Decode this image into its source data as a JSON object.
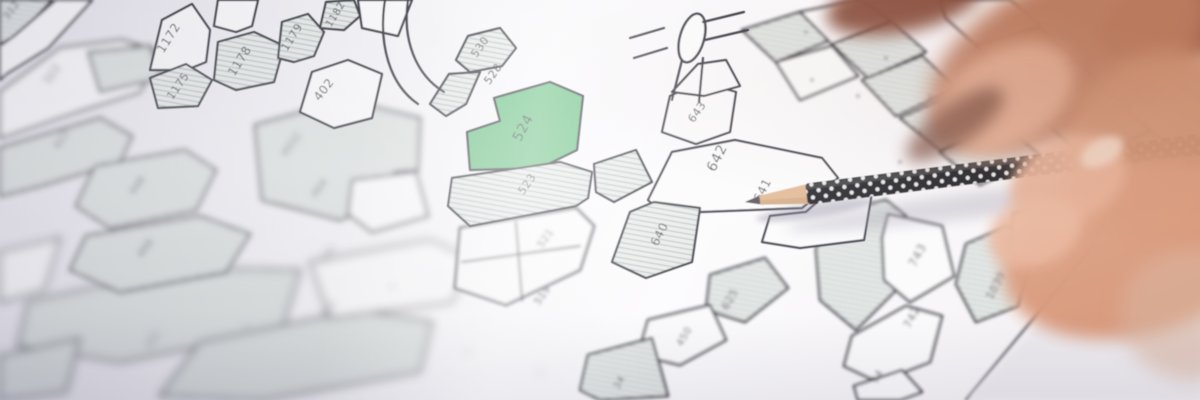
{
  "map": {
    "colors": {
      "line": "#34343e",
      "parcel_white": "#fbfbfc",
      "hatch_base": "#e8ebe9",
      "hatch_line": "#a3aeac",
      "highlight": "#68c081",
      "label": "#3b3b45",
      "highlight_label": "#2f4a38"
    },
    "highlighted_parcel": "524",
    "parcels": [
      {
        "pts": "150,70 162,20 192,4 210,30 206,62 186,70",
        "fill": "white",
        "g": "sharp"
      },
      {
        "pts": "214,26 218,0 258,0 252,26 236,32",
        "fill": "white",
        "g": "sharp"
      },
      {
        "pts": "150,78 186,64 212,80 198,106 158,108",
        "fill": "hatch",
        "g": "sharp"
      },
      {
        "pts": "214,80 218,42 254,32 284,46 274,82 236,90",
        "fill": "hatch",
        "g": "sharp"
      },
      {
        "pts": "278,58 282,22 308,14 324,32 314,56 294,62",
        "fill": "hatch",
        "g": "sharp"
      },
      {
        "pts": "320,28 326,2 354,0 360,16 344,30",
        "fill": "hatch",
        "g": "sharp"
      },
      {
        "pts": "358,0 412,0 398,36 362,28",
        "fill": "white",
        "g": "sharp"
      },
      {
        "pts": "300,112 312,72 348,60 382,74 372,118 334,128",
        "fill": "white",
        "g": "sharp"
      },
      {
        "pts": "456,60 468,36 500,28 516,48 502,66 470,72",
        "fill": "hatch",
        "g": "sharp"
      },
      {
        "pts": "430,104 449,74 480,72 466,104 446,116",
        "fill": "hatch",
        "g": "sharp"
      },
      {
        "pts": "550,82 583,96 577,150 540,168 470,170 467,132 500,121 494,98",
        "fill": "green",
        "g": "sharp"
      },
      {
        "pts": "452,178 560,162 592,172 588,198 576,206 470,226 448,206",
        "fill": "hatch",
        "g": "sharp"
      },
      {
        "pts": "662,132 670,96 700,82 736,92 730,132 696,144",
        "fill": "white",
        "g": "sharp"
      },
      {
        "pts": "672,92 698,64 726,60 740,86 704,96",
        "fill": "white",
        "g": "sharp"
      },
      {
        "pts": "648,200 672,152 735,140 822,158 838,178 802,208 700,212 664,214",
        "fill": "white",
        "g": "sharp"
      },
      {
        "pts": "806,212 840,182 872,192 864,240 800,248 762,242 770,216",
        "fill": "white",
        "g": "sharp"
      },
      {
        "pts": "594,164 636,150 652,182 614,202 596,192",
        "fill": "hatch",
        "g": "sharp"
      },
      {
        "pts": "612,262 630,212 654,202 700,208 692,262 646,278",
        "fill": "hatch",
        "g": "sharp"
      },
      {
        "pts": "0,0 52,0 20,34 0,44",
        "fill": "hatch",
        "g": "soft"
      },
      {
        "pts": "0,46 14,36 56,0 92,0 48,48 6,74 0,80",
        "fill": "white",
        "g": "soft"
      },
      {
        "pts": "710,275 765,258 788,288 745,322 706,310",
        "fill": "hatch",
        "g": "soft"
      },
      {
        "pts": "648,320 710,305 726,340 680,365 638,355",
        "fill": "white",
        "g": "soft"
      },
      {
        "pts": "588,355 652,338 668,396 600,400 580,390",
        "fill": "hatch",
        "g": "soft"
      },
      {
        "pts": "460,228 576,208 594,226 580,270 506,305 455,288",
        "fill": "white",
        "g": "soft"
      },
      {
        "pts": "826,215 886,200 906,216 896,290 856,330 820,300 816,250",
        "fill": "hatch",
        "g": "soft"
      },
      {
        "pts": "888,214 942,226 954,276 910,302 884,280 882,238",
        "fill": "white",
        "g": "soft"
      },
      {
        "pts": "852,336 906,306 942,316 930,362 878,382 844,366",
        "fill": "white",
        "g": "soft"
      },
      {
        "pts": "854,386 902,370 922,392 900,400 858,400",
        "fill": "white",
        "g": "soft"
      },
      {
        "pts": "966,244 1008,226 1034,250 1018,306 976,322 956,284",
        "fill": "hatch",
        "g": "soft"
      },
      {
        "pts": "1014,214 1058,200 1074,240 1040,268 1010,252",
        "fill": "white",
        "g": "soft"
      },
      {
        "pts": "742,30 800,12 830,40 776,62",
        "fill": "hatch",
        "g": "soft"
      },
      {
        "pts": "800,12 860,0 890,20 832,44",
        "fill": "white",
        "g": "soft"
      },
      {
        "pts": "832,44 892,22 926,52 868,78",
        "fill": "hatch",
        "g": "soft"
      },
      {
        "pts": "776,62 832,46 858,76 800,100",
        "fill": "white",
        "g": "soft"
      },
      {
        "pts": "862,80 922,56 956,88 896,116",
        "fill": "hatch",
        "g": "soft"
      },
      {
        "pts": "900,118 960,92 1000,120 940,150",
        "fill": "hatch",
        "g": "soft"
      },
      {
        "pts": "940,0 1010,0 1040,25 976,45 946,18",
        "fill": "white",
        "g": "soft"
      },
      {
        "pts": "976,45 1040,28 1076,60 1010,85",
        "fill": "hatch",
        "g": "soft"
      },
      {
        "pts": "1010,85 1078,62 1110,95 1046,122",
        "fill": "white",
        "g": "soft"
      },
      {
        "pts": "1046,122 1112,98 1150,130 1086,160",
        "fill": "hatch",
        "g": "soft"
      },
      {
        "pts": "1086,160 1152,132 1190,165 1124,195",
        "fill": "white",
        "g": "soft"
      },
      {
        "pts": "940,152 1002,124 1040,155 980,185",
        "fill": "hatch",
        "g": "soft"
      },
      {
        "pts": "0,92 60,48 122,40 160,52 140,92 76,112 0,138",
        "fill": "white",
        "g": "blur"
      },
      {
        "pts": "88,52 150,46 162,78 100,92",
        "fill": "hatch",
        "g": "blur"
      },
      {
        "pts": "0,148 100,118 132,136 120,162 40,186 0,196",
        "fill": "hatch",
        "g": "blur"
      },
      {
        "pts": "95,166 185,150 216,170 196,210 110,228 76,206",
        "fill": "hatch",
        "g": "blur"
      },
      {
        "pts": "86,236 200,216 250,234 226,272 120,292 70,270",
        "fill": "hatch",
        "g": "blur"
      },
      {
        "pts": "255,125 345,100 420,118 418,170 394,172 394,198 340,220 262,200",
        "fill": "hatch",
        "g": "blur"
      },
      {
        "pts": "352,180 416,172 428,216 372,232 348,214",
        "fill": "white",
        "g": "blur"
      },
      {
        "pts": "28,302 180,268 300,270 282,330 120,362 18,346",
        "fill": "hatch",
        "g": "heavy"
      },
      {
        "pts": "0,252 60,238 44,290 0,302",
        "fill": "white",
        "g": "heavy"
      },
      {
        "pts": "200,342 358,310 432,322 420,372 262,400 160,396",
        "fill": "hatch",
        "g": "heavy"
      },
      {
        "pts": "310,262 430,240 470,258 452,302 330,318",
        "fill": "white",
        "g": "heavy"
      },
      {
        "pts": "0,356 80,338 66,392 0,400",
        "fill": "hatch",
        "g": "heavy"
      }
    ],
    "labels": [
      {
        "t": "312",
        "x": 14,
        "y": 12,
        "r": -55,
        "s": 10,
        "g": "soft"
      },
      {
        "t": "1172",
        "x": 172,
        "y": 40,
        "r": -58,
        "s": 12,
        "g": "sharp"
      },
      {
        "t": "1175",
        "x": 181,
        "y": 88,
        "r": -55,
        "s": 11,
        "g": "sharp"
      },
      {
        "t": "1178",
        "x": 243,
        "y": 63,
        "r": -58,
        "s": 12,
        "g": "sharp"
      },
      {
        "t": "1179",
        "x": 295,
        "y": 39,
        "r": -58,
        "s": 11,
        "g": "sharp"
      },
      {
        "t": "1182",
        "x": 338,
        "y": 16,
        "r": -58,
        "s": 10,
        "g": "sharp"
      },
      {
        "t": "402",
        "x": 327,
        "y": 92,
        "r": -52,
        "s": 12,
        "g": "sharp"
      },
      {
        "t": "530",
        "x": 483,
        "y": 49,
        "r": -55,
        "s": 11,
        "g": "sharp"
      },
      {
        "t": "528",
        "x": 496,
        "y": 76,
        "r": -55,
        "s": 11,
        "g": "sharp"
      },
      {
        "t": "524",
        "x": 527,
        "y": 130,
        "r": -62,
        "s": 14,
        "g": "sharp",
        "c": "#2f4a38"
      },
      {
        "t": "523",
        "x": 530,
        "y": 186,
        "r": -55,
        "s": 11,
        "g": "sharp"
      },
      {
        "t": "643",
        "x": 700,
        "y": 114,
        "r": -55,
        "s": 11,
        "g": "sharp"
      },
      {
        "t": "642",
        "x": 721,
        "y": 160,
        "r": -63,
        "s": 14,
        "g": "sharp"
      },
      {
        "t": "641",
        "x": 766,
        "y": 192,
        "r": -63,
        "s": 12,
        "g": "sharp"
      },
      {
        "t": "640",
        "x": 663,
        "y": 236,
        "r": -63,
        "s": 12,
        "g": "sharp"
      },
      {
        "t": "625",
        "x": 733,
        "y": 301,
        "r": -60,
        "s": 11,
        "g": "soft"
      },
      {
        "t": "450",
        "x": 687,
        "y": 338,
        "r": -60,
        "s": 10,
        "g": "soft"
      },
      {
        "t": "34",
        "x": 622,
        "y": 384,
        "r": -60,
        "s": 10,
        "g": "soft"
      },
      {
        "t": "521",
        "x": 548,
        "y": 240,
        "r": -55,
        "s": 10,
        "g": "soft"
      },
      {
        "t": "519",
        "x": 545,
        "y": 297,
        "r": -55,
        "s": 10,
        "g": "soft"
      },
      {
        "t": "743",
        "x": 921,
        "y": 257,
        "r": -62,
        "s": 12,
        "g": "soft"
      },
      {
        "t": "742",
        "x": 915,
        "y": 319,
        "r": -62,
        "s": 11,
        "g": "soft"
      },
      {
        "t": "1039",
        "x": 999,
        "y": 287,
        "r": -62,
        "s": 11,
        "g": "soft"
      },
      {
        "t": "1038",
        "x": 1036,
        "y": 249,
        "r": -62,
        "s": 10,
        "g": "soft"
      },
      {
        "t": "94",
        "x": 880,
        "y": 378,
        "r": -60,
        "s": 10,
        "g": "soft"
      },
      {
        "t": "322",
        "x": 55,
        "y": 76,
        "r": -55,
        "s": 11,
        "g": "blur"
      },
      {
        "t": "422",
        "x": 64,
        "y": 141,
        "r": -55,
        "s": 10,
        "g": "blur"
      },
      {
        "t": "448",
        "x": 140,
        "y": 187,
        "r": -55,
        "s": 10,
        "g": "blur"
      },
      {
        "t": "468",
        "x": 148,
        "y": 250,
        "r": -55,
        "s": 10,
        "g": "blur"
      },
      {
        "t": "4032",
        "x": 294,
        "y": 146,
        "r": -55,
        "s": 10,
        "g": "blur"
      },
      {
        "t": "404",
        "x": 322,
        "y": 190,
        "r": -55,
        "s": 10,
        "g": "blur"
      },
      {
        "t": "443",
        "x": 155,
        "y": 341,
        "r": -55,
        "s": 9,
        "g": "heavy"
      },
      {
        "t": "454",
        "x": 330,
        "y": 257,
        "r": -55,
        "s": 9,
        "g": "heavy"
      },
      {
        "t": "453",
        "x": 331,
        "y": 311,
        "r": -55,
        "s": 9,
        "g": "heavy"
      }
    ],
    "lines": [
      {
        "d": "M385,0 C378,45 390,85 418,104",
        "g": "sharp",
        "w": 2.2
      },
      {
        "d": "M408,0 C402,40 416,75 444,92",
        "g": "sharp",
        "w": 2.2
      },
      {
        "d": "M682,60 L672,100",
        "g": "sharp",
        "w": 2.2
      },
      {
        "d": "M703,58 L699,102",
        "g": "sharp",
        "w": 2.2
      },
      {
        "d": "M664,28 L630,38",
        "g": "sharp",
        "w": 2.2
      },
      {
        "d": "M667,48 L634,58",
        "g": "sharp",
        "w": 2.2
      },
      {
        "d": "M703,22 L744,12",
        "g": "sharp",
        "w": 2.2
      },
      {
        "d": "M705,40 L748,30",
        "g": "sharp",
        "w": 2.2
      },
      {
        "d": "M462,262 L580,246",
        "g": "soft",
        "w": 1.7
      },
      {
        "d": "M516,222 L522,300",
        "g": "soft",
        "w": 1.7
      },
      {
        "d": "M966,400 L1092,248 L1124,180",
        "g": "soft",
        "w": 2
      }
    ],
    "roundabout": {
      "cx": 692,
      "cy": 38,
      "rx": 12,
      "ry": 25,
      "rot": 16
    },
    "tiny_marks": [
      {
        "x": 806,
        "y": 32,
        "g": "soft"
      },
      {
        "x": 852,
        "y": 18,
        "g": "soft"
      },
      {
        "x": 886,
        "y": 58,
        "g": "soft"
      },
      {
        "x": 930,
        "y": 96,
        "g": "soft"
      },
      {
        "x": 966,
        "y": 62,
        "g": "soft"
      },
      {
        "x": 1012,
        "y": 48,
        "g": "soft"
      },
      {
        "x": 1056,
        "y": 92,
        "g": "soft"
      },
      {
        "x": 988,
        "y": 132,
        "g": "soft"
      },
      {
        "x": 920,
        "y": 132,
        "g": "soft"
      },
      {
        "x": 858,
        "y": 96,
        "g": "soft"
      },
      {
        "x": 812,
        "y": 80,
        "g": "soft"
      },
      {
        "x": 900,
        "y": 162,
        "g": "soft"
      },
      {
        "x": 952,
        "y": 162,
        "g": "soft"
      },
      {
        "x": 1032,
        "y": 122,
        "g": "soft"
      },
      {
        "x": 247,
        "y": 327,
        "g": "heavy"
      },
      {
        "x": 468,
        "y": 352,
        "g": "heavy"
      },
      {
        "x": 392,
        "y": 287,
        "g": "heavy"
      },
      {
        "x": 540,
        "y": 372,
        "g": "heavy"
      }
    ],
    "paper_edge": {
      "pts": "966,400 1044,318 1092,248 1122,182 1200,164 1200,400",
      "fill": "#edeaee"
    }
  },
  "pencil": {
    "tip_x": 745,
    "tip_y": 202,
    "angle": -7.2,
    "length": 480,
    "body_color": "#16161b",
    "dot_color": "#f5f5f5",
    "wood_color": "#dfb48e",
    "wood_shade": "#c49a70",
    "graphite_color": "#47474d",
    "shadows": [
      {
        "cx": 985,
        "cy": 204,
        "rx": 200,
        "ry": 13,
        "rot": -7,
        "fill": "#948da0",
        "op": 0.32,
        "f": "f-b6"
      },
      {
        "cx": 815,
        "cy": 210,
        "rx": 60,
        "ry": 7,
        "rot": -9,
        "fill": "#7e7790",
        "op": 0.4,
        "f": "f-b3"
      }
    ]
  },
  "hand": {
    "blobs": [
      {
        "cx": 905,
        "cy": 2,
        "rx": 80,
        "ry": 30,
        "rot": -12,
        "fill": "#8a4f3c",
        "f": "f-b8",
        "op": 0.96
      },
      {
        "cx": 1190,
        "cy": 12,
        "rx": 95,
        "ry": 50,
        "rot": -20,
        "fill": "#9a5a44",
        "f": "f-b8",
        "op": 0.95
      },
      {
        "cx": 1068,
        "cy": 55,
        "rx": 150,
        "ry": 80,
        "rot": -27,
        "fill": "#bd7d60",
        "f": "f-b10",
        "op": 0.97
      },
      {
        "cx": 1005,
        "cy": 98,
        "rx": 75,
        "ry": 48,
        "rot": -30,
        "fill": "#e2ab90",
        "f": "f-b8",
        "op": 0.9
      },
      {
        "cx": 955,
        "cy": 125,
        "rx": 58,
        "ry": 20,
        "rot": -35,
        "fill": "#744434",
        "f": "f-b8",
        "op": 0.75
      },
      {
        "cx": 1180,
        "cy": 150,
        "rx": 115,
        "ry": 100,
        "rot": 0,
        "fill": "#cf9171",
        "f": "f-b10",
        "op": 0.97
      },
      {
        "cx": 1135,
        "cy": 250,
        "rx": 135,
        "ry": 85,
        "rot": -15,
        "fill": "#d99a7c",
        "f": "f-b8",
        "op": 0.97
      },
      {
        "cx": 1068,
        "cy": 180,
        "rx": 60,
        "ry": 42,
        "rot": -22,
        "fill": "#e5ad92",
        "f": "f-b6",
        "op": 0.95
      },
      {
        "cx": 1102,
        "cy": 152,
        "rx": 23,
        "ry": 13,
        "rot": -28,
        "fill": "#eed2c0",
        "f": "f-b4",
        "op": 0.9
      },
      {
        "cx": 1035,
        "cy": 232,
        "rx": 48,
        "ry": 34,
        "rot": -20,
        "fill": "#e8b49a",
        "f": "f-b6",
        "op": 0.95
      },
      {
        "cx": 1195,
        "cy": 315,
        "rx": 75,
        "ry": 65,
        "rot": 0,
        "fill": "#d9b49f",
        "f": "f-b10",
        "op": 0.6
      }
    ]
  }
}
